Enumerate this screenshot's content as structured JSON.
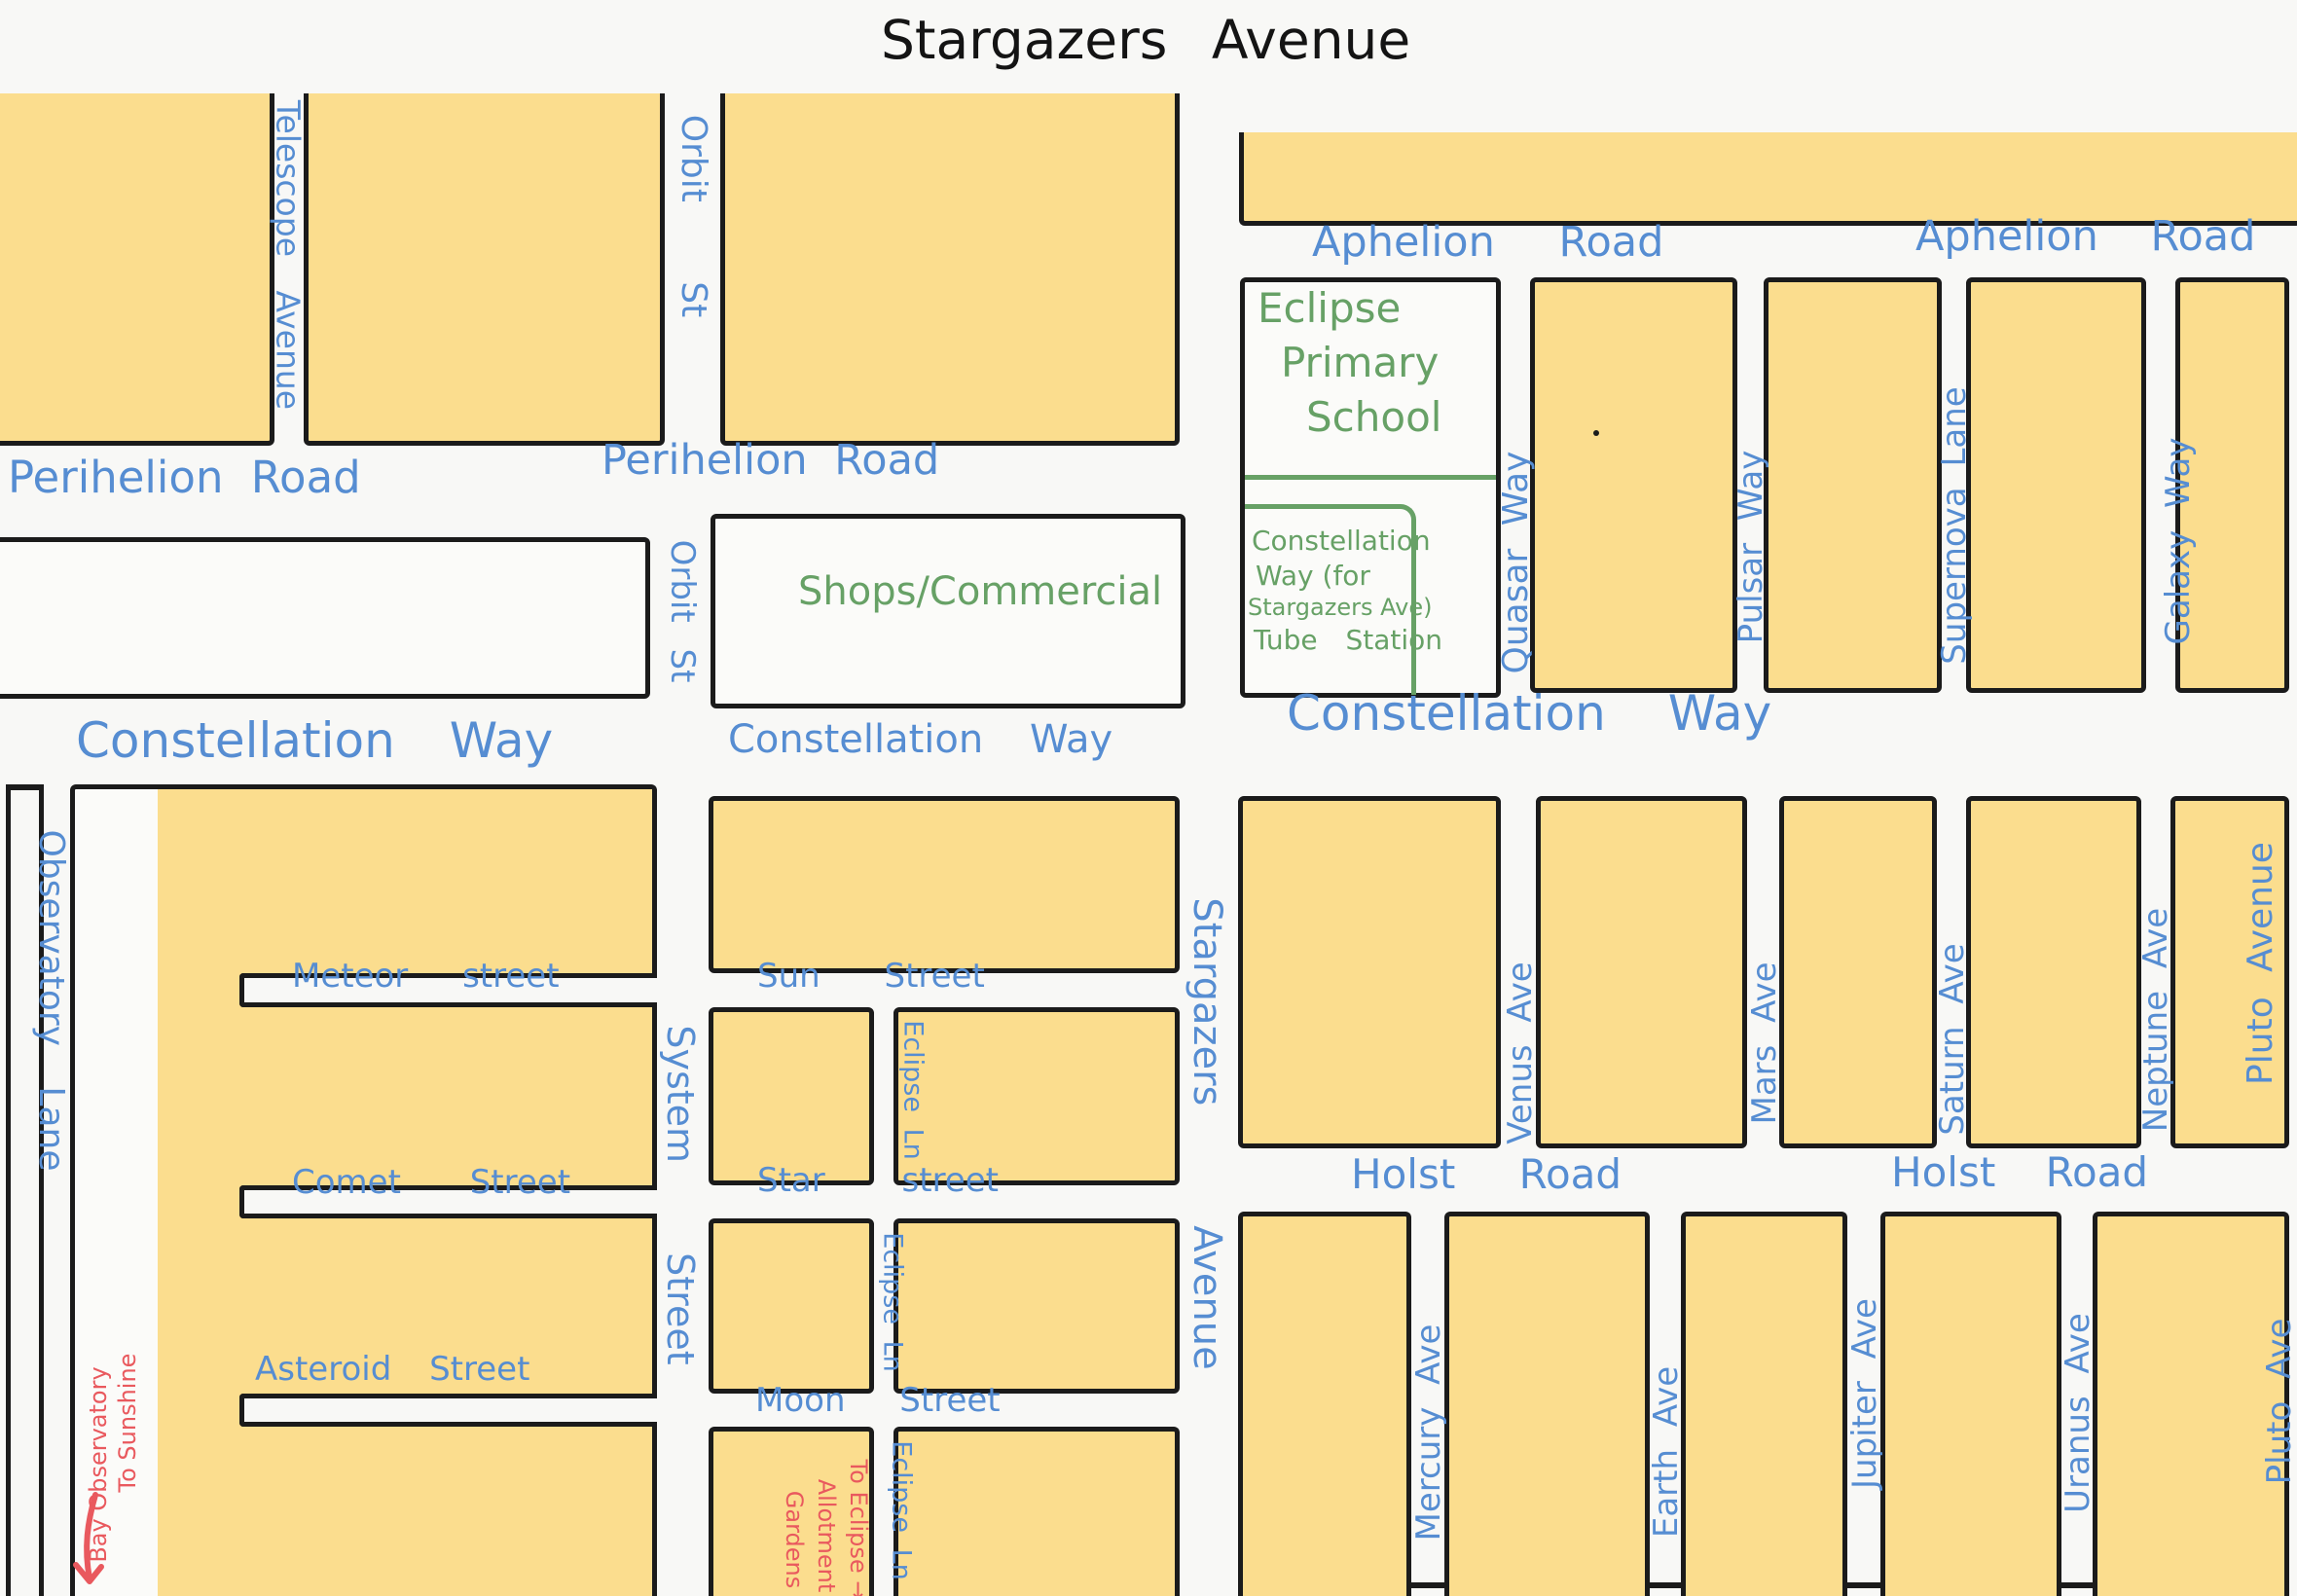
{
  "title": "Stargazers Avenue",
  "colors": {
    "block_fill": "#fbdd8e",
    "road_label_blue": "#568dd2",
    "place_label_green": "#67a166",
    "note_label_red": "#e9595e",
    "outline_black": "#1b1b1b"
  },
  "roads": {
    "perihelion_w": "Perihelion Road",
    "perihelion_e": "Perihelion Road",
    "aphelion_w": "Aphelion Road",
    "aphelion_e": "Aphelion Road",
    "constellation_w": "Constellation Way",
    "constellation_c": "Constellation Way",
    "constellation_e": "Constellation Way",
    "holst_w": "Holst Road",
    "holst_e": "Holst Road",
    "meteor": "Meteor street",
    "comet": "Comet Street",
    "asteroid": "Asteroid Street",
    "sun": "Sun Street",
    "star": "Star street",
    "moon": "Moon Street",
    "telescope": "Telescope Avenue",
    "orbit_n": "Orbit St",
    "orbit_s": "Orbit St",
    "system": "System Street",
    "eclipse_ln_1": "Eclipse Ln",
    "eclipse_ln_2": "Eclipse Ln",
    "eclipse_ln_3": "Eclipse Ln",
    "stargazers_v": "Stargazers Avenue",
    "observatory": "Observatory Lane",
    "quasar": "Quasar Way",
    "pulsar": "Pulsar Way",
    "supernova": "Supernova Lane",
    "galaxy": "Galaxy Way",
    "venus": "Venus Ave",
    "mars": "Mars Ave",
    "saturn": "Saturn Ave",
    "neptune": "Neptune Ave",
    "pluto_n": "Pluto Avenue",
    "mercury": "Mercury Ave",
    "earth": "Earth Ave",
    "jupiter": "Jupiter Ave",
    "uranus": "Uranus Ave",
    "pluto_s": "Pluto Ave"
  },
  "places": {
    "school_line1": "Eclipse",
    "school_line2": "Primary",
    "school_line3": "School",
    "tube_line1": "Constellation",
    "tube_line2": "Way (for",
    "tube_line3": "Stargazers Ave)",
    "tube_line4": "Tube Station",
    "shops": "Shops/Commercial"
  },
  "notes": {
    "sunshine_line1": "To Sunshine",
    "sunshine_line2": "Bay Observatory",
    "allotment_line1": "To Eclipse →",
    "allotment_line2": "Allotment",
    "allotment_line3": "Gardens"
  }
}
